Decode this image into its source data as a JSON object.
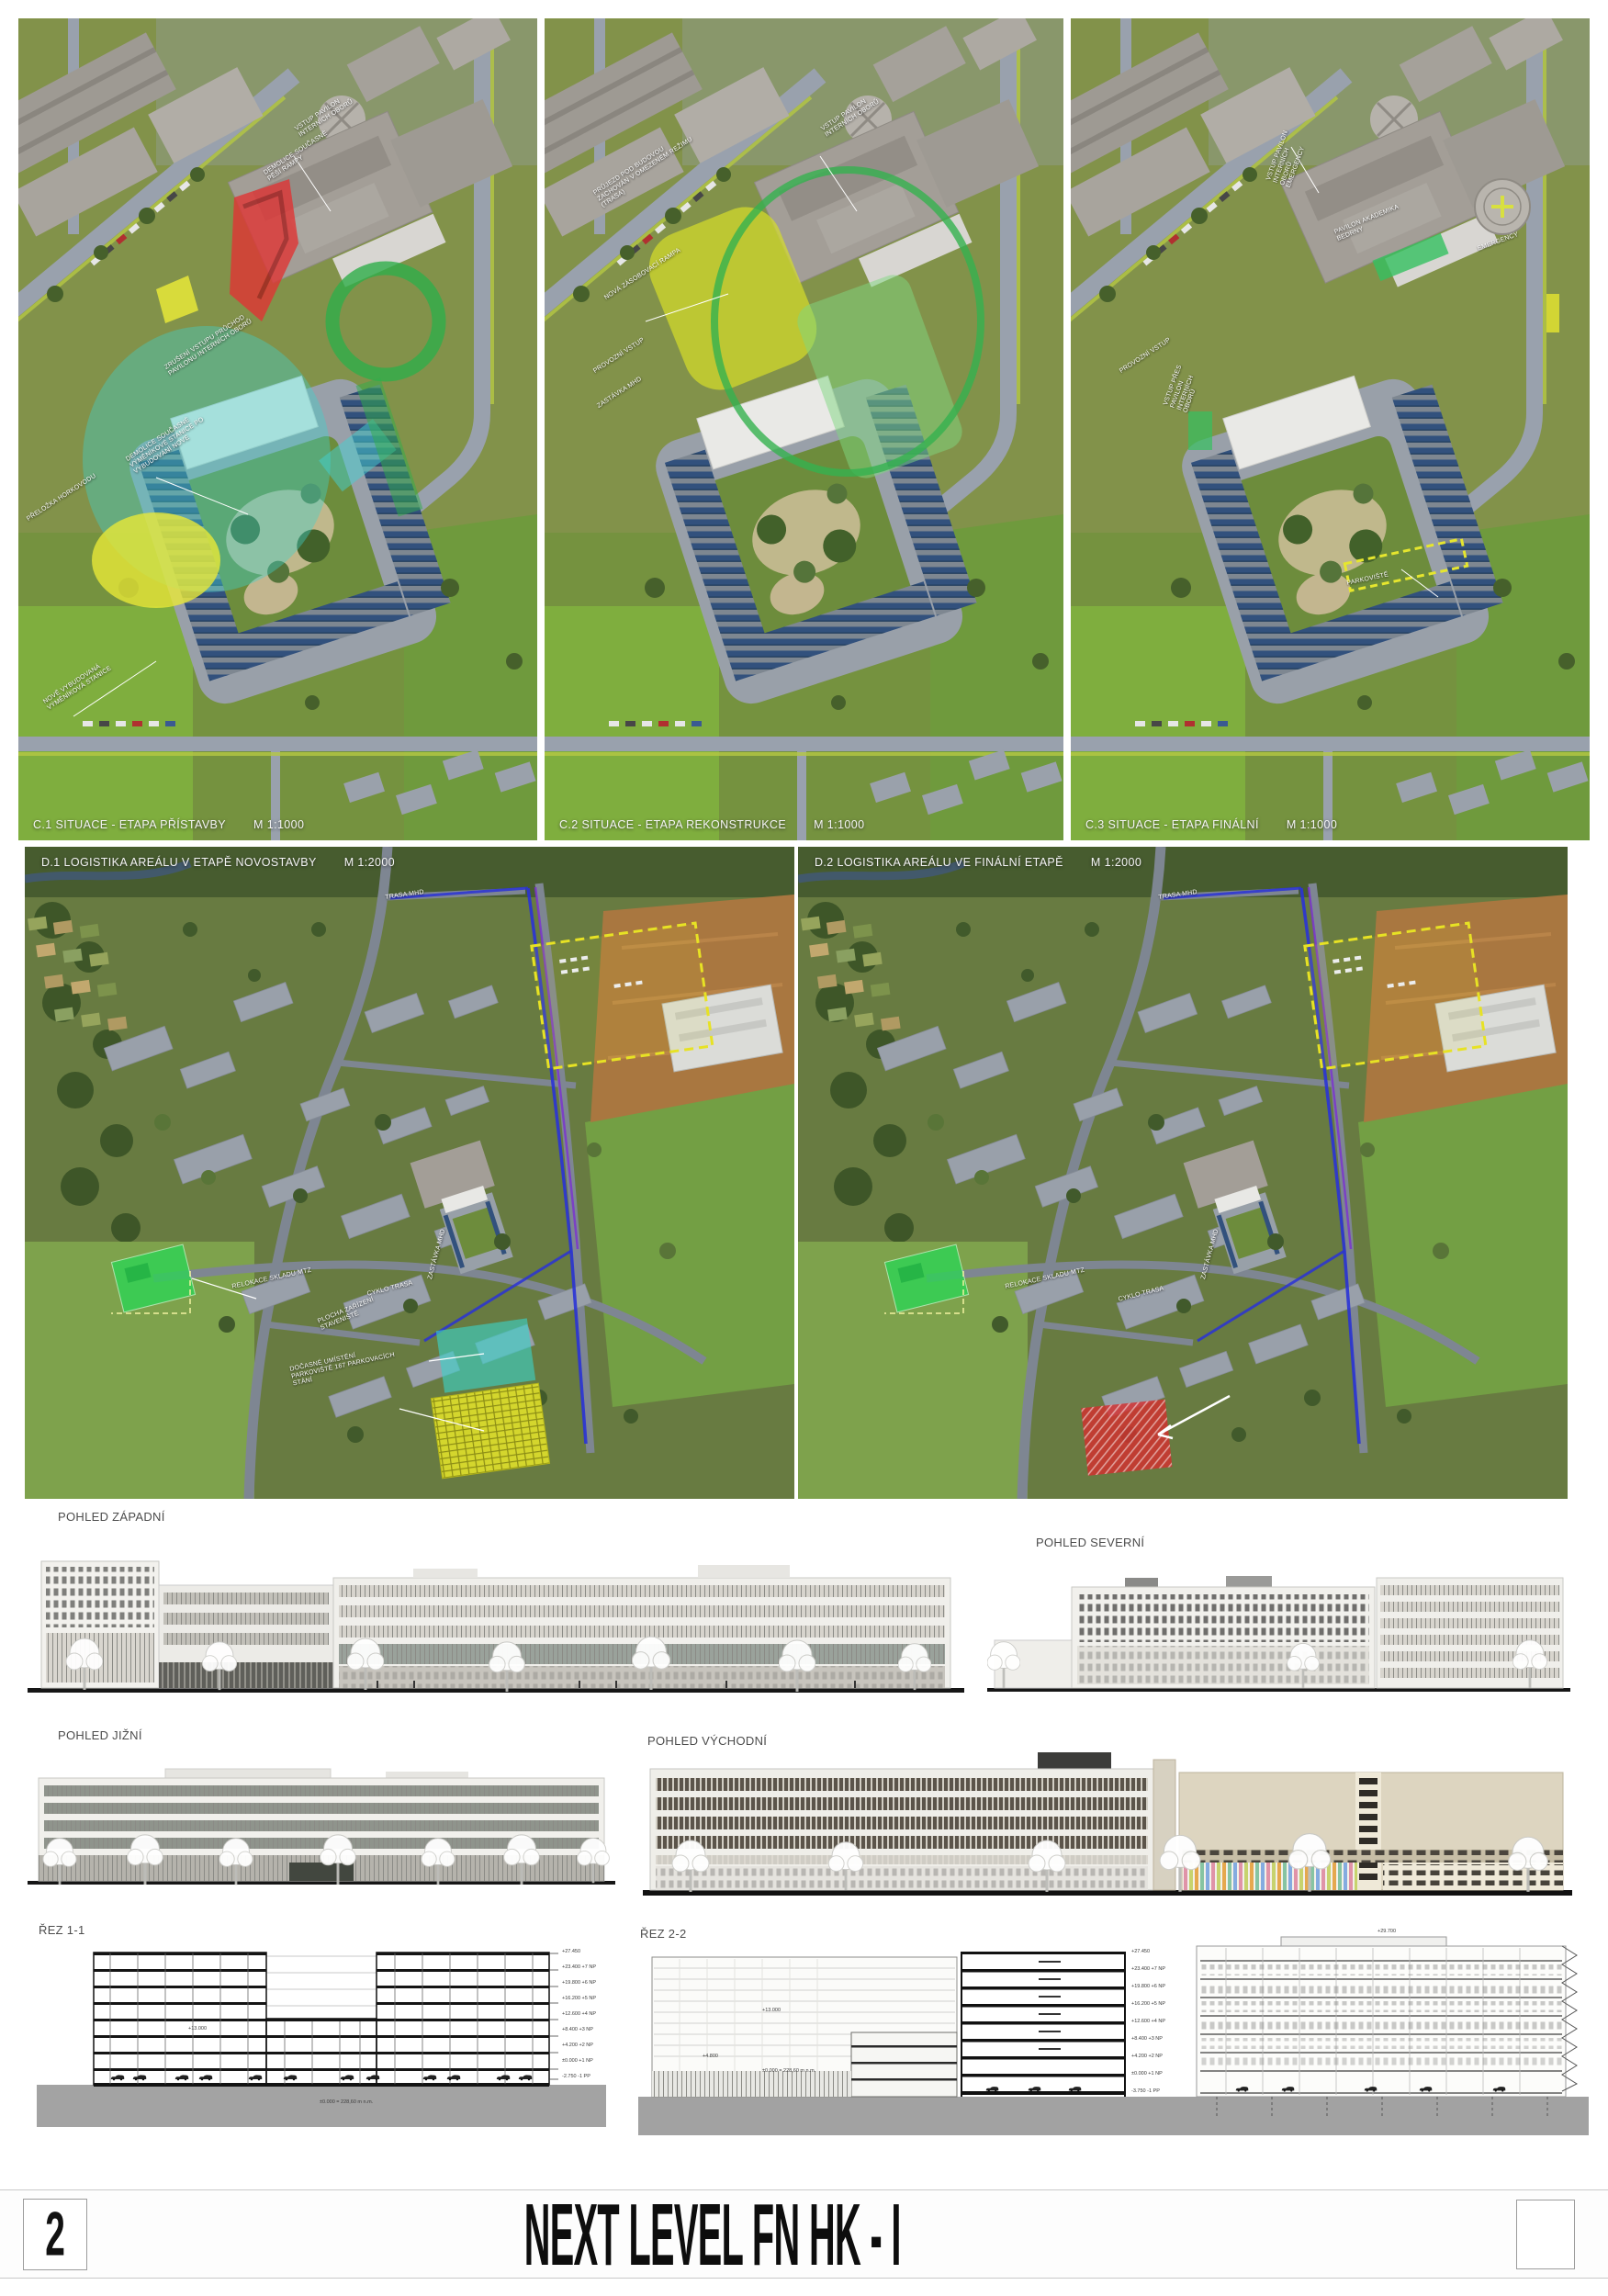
{
  "board": {
    "page_number": "2",
    "title": "NEXT LEVEL FN HK - I"
  },
  "top_row": {
    "panels": [
      {
        "caption": "C.1 SITUACE - ETAPA PŘÍSTAVBY",
        "scale": "M 1:1000",
        "annotations": [
          "VSTUP PAVILON INTERNÍCH OBORŮ",
          "DEMOLICE SOUČASNÉ PĚŠÍ RAMPY",
          "ZRUŠENÍ VSTUPU PRŮCHOD PAVILONU INTERNÍCH OBORŮ",
          "DEMOLICE SOUČASNÉ VÝMĚNÍKOVÉ STANICE PO VYBUDOVÁNÍ NOVÉ",
          "NOVĚ VYBUDOVANÁ VÝMĚNÍKOVÁ STANICE",
          "PŘELOŽKA HORKOVODU"
        ]
      },
      {
        "caption": "C.2 SITUACE - ETAPA REKONSTRUKCE",
        "scale": "M 1:1000",
        "annotations": [
          "VSTUP PAVILON INTERNÍCH OBORŮ",
          "PRŮJEZD POD BUDOVOU ZACHOVÁN V OMEZENÉM REŽIMU (TRASA)",
          "NOVÁ ZÁSOBOVACÍ RAMPA",
          "PROVOZNÍ VSTUP",
          "ZASTÁVKA MHD"
        ]
      },
      {
        "caption": "C.3 SITUACE - ETAPA FINÁLNÍ",
        "scale": "M 1:1000",
        "annotations": [
          "VSTUP PAVILON INTERNÍCH OBORŮ EMERGENCY",
          "VSTUP PŘES PAVILON INTERNÍCH OBORŮ",
          "EMERGENCY",
          "PAVILON AKADEMIKA BEDRNY",
          "PROVOZNÍ VSTUP",
          "PARKOVIŠTĚ"
        ]
      }
    ]
  },
  "middle_row": {
    "panels": [
      {
        "caption": "D.1 LOGISTIKA AREÁLU V ETAPĚ NOVOSTAVBY",
        "scale": "M 1:2000",
        "annotations": [
          "TRASA MHD",
          "ZASTÁVKA MHD",
          "RELOKACE SKLADU MTZ",
          "CYKLO TRASA",
          "PLOCHA ZAŘÍZENÍ STAVENIŠTĚ",
          "DOČASNÉ UMÍSTĚNÍ PARKOVIŠTĚ 167 PARKOVACÍCH STÁNÍ"
        ]
      },
      {
        "caption": "D.2 LOGISTIKA AREÁLU VE FINÁLNÍ ETAPĚ",
        "scale": "M 1:2000",
        "annotations": [
          "TRASA MHD",
          "ZASTÁVKA MHD",
          "RELOKACE SKLADU MTZ",
          "CYKLO TRASA"
        ]
      }
    ]
  },
  "elevations": [
    {
      "label": "POHLED ZÁPADNÍ"
    },
    {
      "label": "POHLED SEVERNÍ"
    },
    {
      "label": "POHLED JIŽNÍ"
    },
    {
      "label": "POHLED VÝCHODNÍ"
    }
  ],
  "sections": [
    {
      "label": "ŘEZ 1-1",
      "datum": "±0.000 = 228,60 m n.m.",
      "mid_label": "+13.000",
      "levels": [
        "+27.450",
        "+23.400 +7 NP",
        "+19.800 +6 NP",
        "+16.200 +5 NP",
        "+12.600 +4 NP",
        "+8.400 +3 NP",
        "+4.200 +2 NP",
        "±0.000 +1 NP",
        "-2.750 -1 PP"
      ]
    },
    {
      "label": "ŘEZ 2-2",
      "datum": "±0.000 = 228,60 m n.m.",
      "mid_label": "+13.000",
      "low_label": "+4.800",
      "top_label": "+29.700",
      "levels": [
        "+27.450",
        "+23.400 +7 NP",
        "+19.800 +6 NP",
        "+16.200 +5 NP",
        "+12.600 +4 NP",
        "+8.400 +3 NP",
        "+4.200 +2 NP",
        "±0.000 +1 NP",
        "-3.750 -1 PP"
      ]
    }
  ],
  "colors": {
    "highlight_red": "#d32f2f",
    "highlight_yellow": "#dede2c",
    "highlight_cyan": "#3ed2c8",
    "highlight_green": "#2ed455",
    "route_blue": "#2a33d6",
    "route_purple": "#7b2fd2",
    "grass": "#7f8f4a",
    "road": "#99a1ad",
    "solar_blue": "#32517d"
  }
}
